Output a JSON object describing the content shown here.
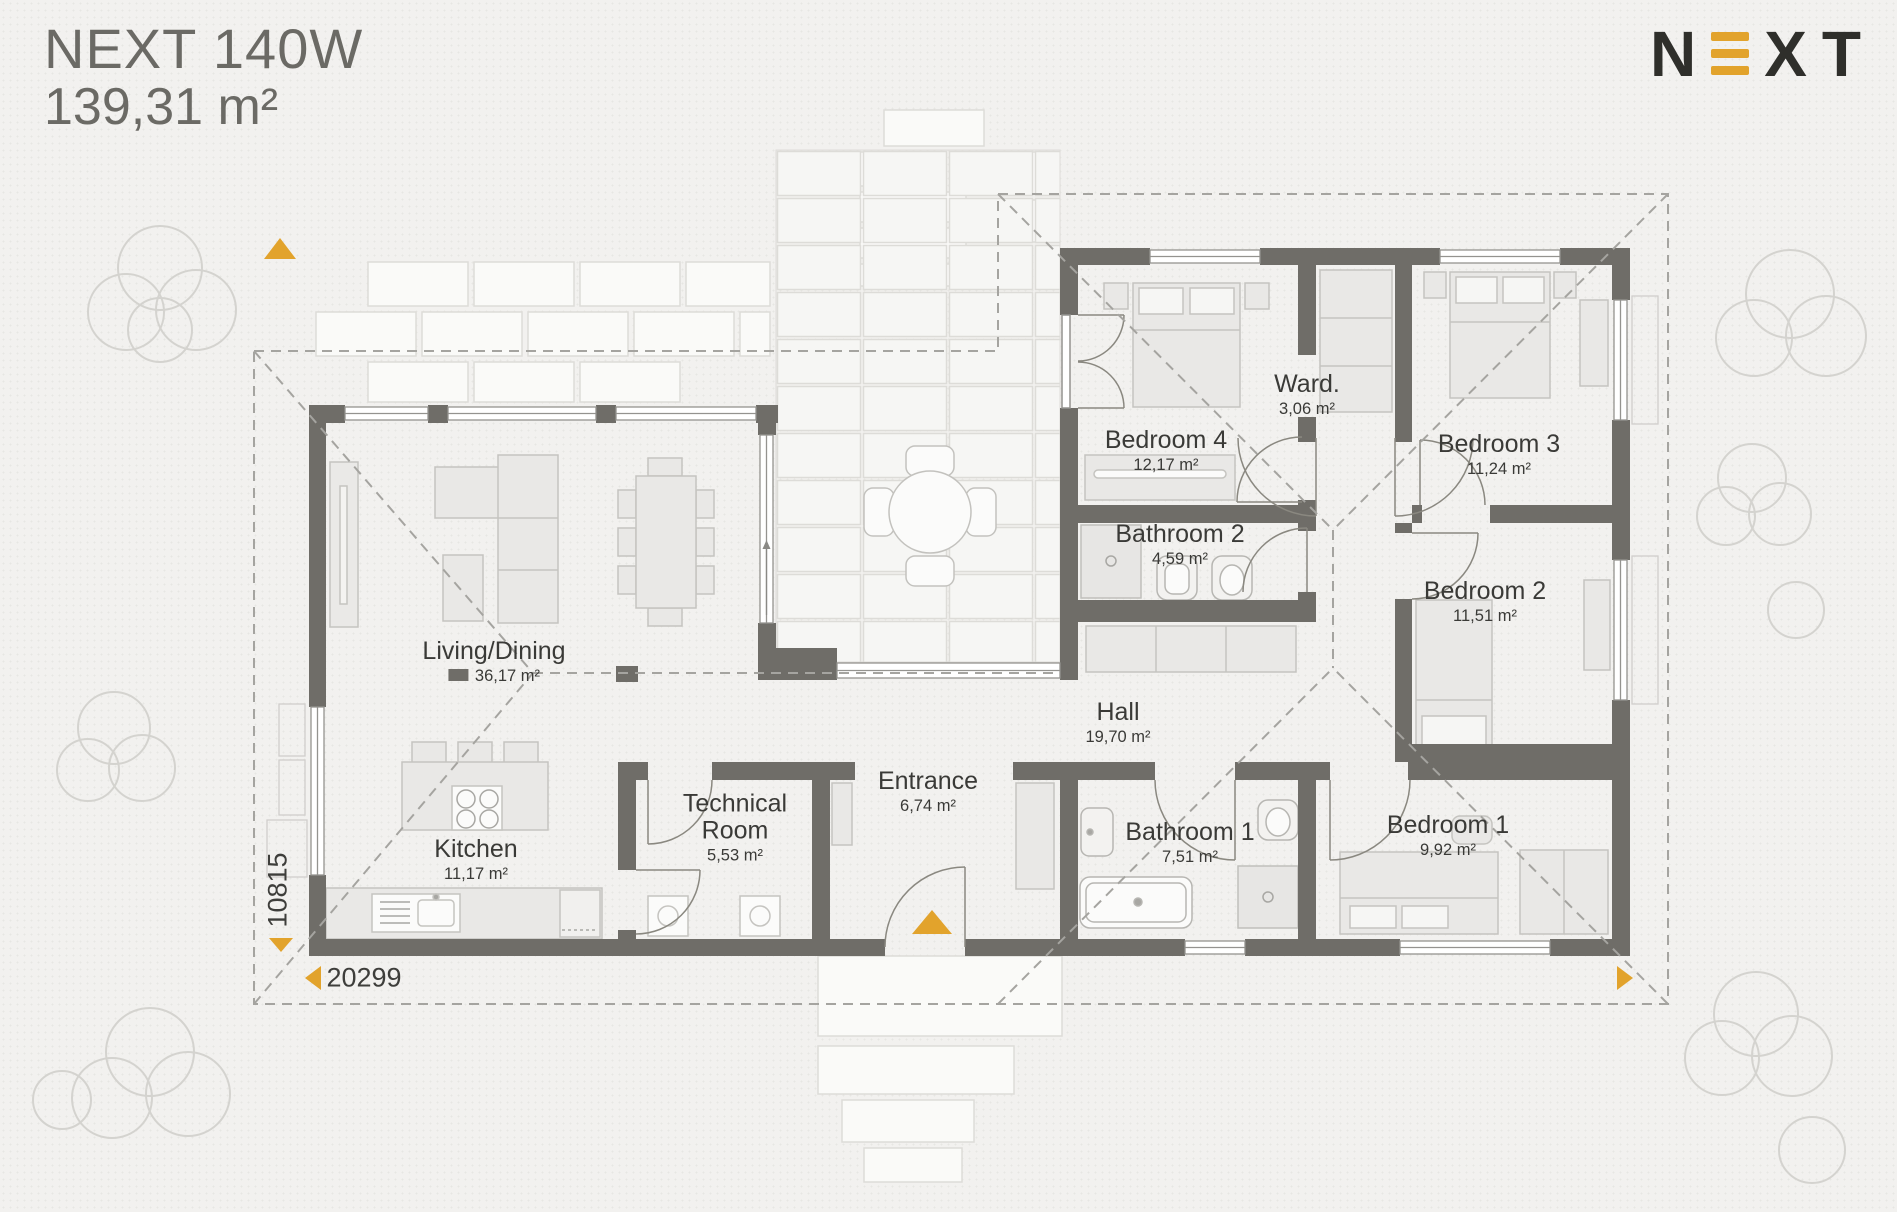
{
  "header": {
    "model": "NEXT 140W",
    "total_area": "139,31 m²"
  },
  "brand": {
    "letter_n": "N",
    "letter_x": "X",
    "letter_t": "T"
  },
  "rooms": {
    "living": {
      "name": "Living/Dining",
      "area": "36,17 m²"
    },
    "kitchen": {
      "name": "Kitchen",
      "area": "11,17 m²"
    },
    "technical": {
      "name": "Technical Room",
      "area": "5,53 m²"
    },
    "entrance": {
      "name": "Entrance",
      "area": "6,74 m²"
    },
    "hall": {
      "name": "Hall",
      "area": "19,70 m²"
    },
    "bathroom1": {
      "name": "Bathroom 1",
      "area": "7,51 m²"
    },
    "bedroom1": {
      "name": "Bedroom 1",
      "area": "9,92 m²"
    },
    "bathroom2": {
      "name": "Bathroom 2",
      "area": "4,59 m²"
    },
    "bedroom2": {
      "name": "Bedroom 2",
      "area": "11,51 m²"
    },
    "bedroom3": {
      "name": "Bedroom 3",
      "area": "11,24 m²"
    },
    "bedroom4": {
      "name": "Bedroom 4",
      "area": "12,17 m²"
    },
    "wardrobe": {
      "name": "Ward.",
      "area": "3,06 m²"
    }
  },
  "dimensions": {
    "width_mm": "20299",
    "height_mm": "10815"
  },
  "colors": {
    "wall": "#6f6d68",
    "accent": "#e2a32c"
  }
}
